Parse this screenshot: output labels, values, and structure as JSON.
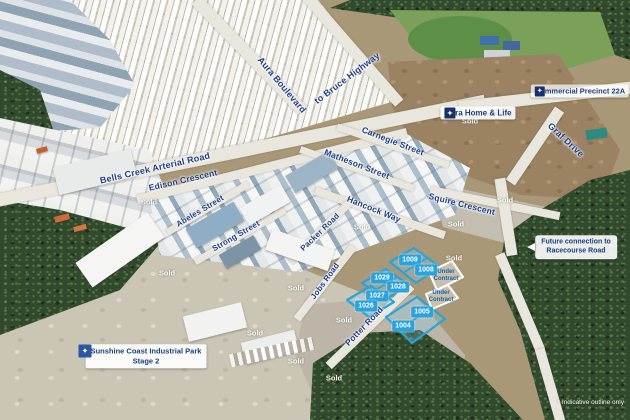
{
  "meta": {
    "footnote": "* Indicative outline only"
  },
  "colors": {
    "accent_blue": "#2AA2DC",
    "navy": "#1E3F86",
    "callout_navy": "#1B3F7F"
  },
  "labels": {
    "sold": "Sold"
  },
  "roads": [
    {
      "id": "bells-creek-arterial-road",
      "label": "Bells Creek Arterial Road"
    },
    {
      "id": "edison-crescent",
      "label": "Edison Crescent"
    },
    {
      "id": "abeles-street",
      "label": "Abeles Street"
    },
    {
      "id": "strong-street",
      "label": "Strong Street"
    },
    {
      "id": "carnegie-street",
      "label": "Carnegie Street"
    },
    {
      "id": "matheson-street",
      "label": "Matheson Street"
    },
    {
      "id": "hancock-way",
      "label": "Hancock Way"
    },
    {
      "id": "packer-road",
      "label": "Packer Road"
    },
    {
      "id": "squire-crescent",
      "label": "Squire Crescent"
    },
    {
      "id": "graf-drive",
      "label": "Graf Drive"
    },
    {
      "id": "jobs-road",
      "label": "Jobs Road"
    },
    {
      "id": "potter-road",
      "label": "Potter Road"
    },
    {
      "id": "aura-boulevard",
      "label": "Aura Boulevard"
    },
    {
      "id": "to-bruce-highway",
      "label": "to Bruce Highway"
    }
  ],
  "lots": [
    {
      "number": "1009"
    },
    {
      "number": "1008"
    },
    {
      "number": "1029"
    },
    {
      "number": "1028"
    },
    {
      "number": "1027"
    },
    {
      "number": "1026"
    },
    {
      "number": "1005"
    },
    {
      "number": "1004"
    }
  ],
  "under_contract": {
    "line1": "Under",
    "line2": "Contract"
  },
  "callouts": {
    "aura_home_life": "Aura Home & Life",
    "commercial_precinct": "Commercial Precinct 22A",
    "future_connection_line1": "Future connection to",
    "future_connection_line2": "Racecourse Road",
    "stage_line1": "Sunshine Coast Industrial Park",
    "stage_line2": "Stage 2"
  }
}
